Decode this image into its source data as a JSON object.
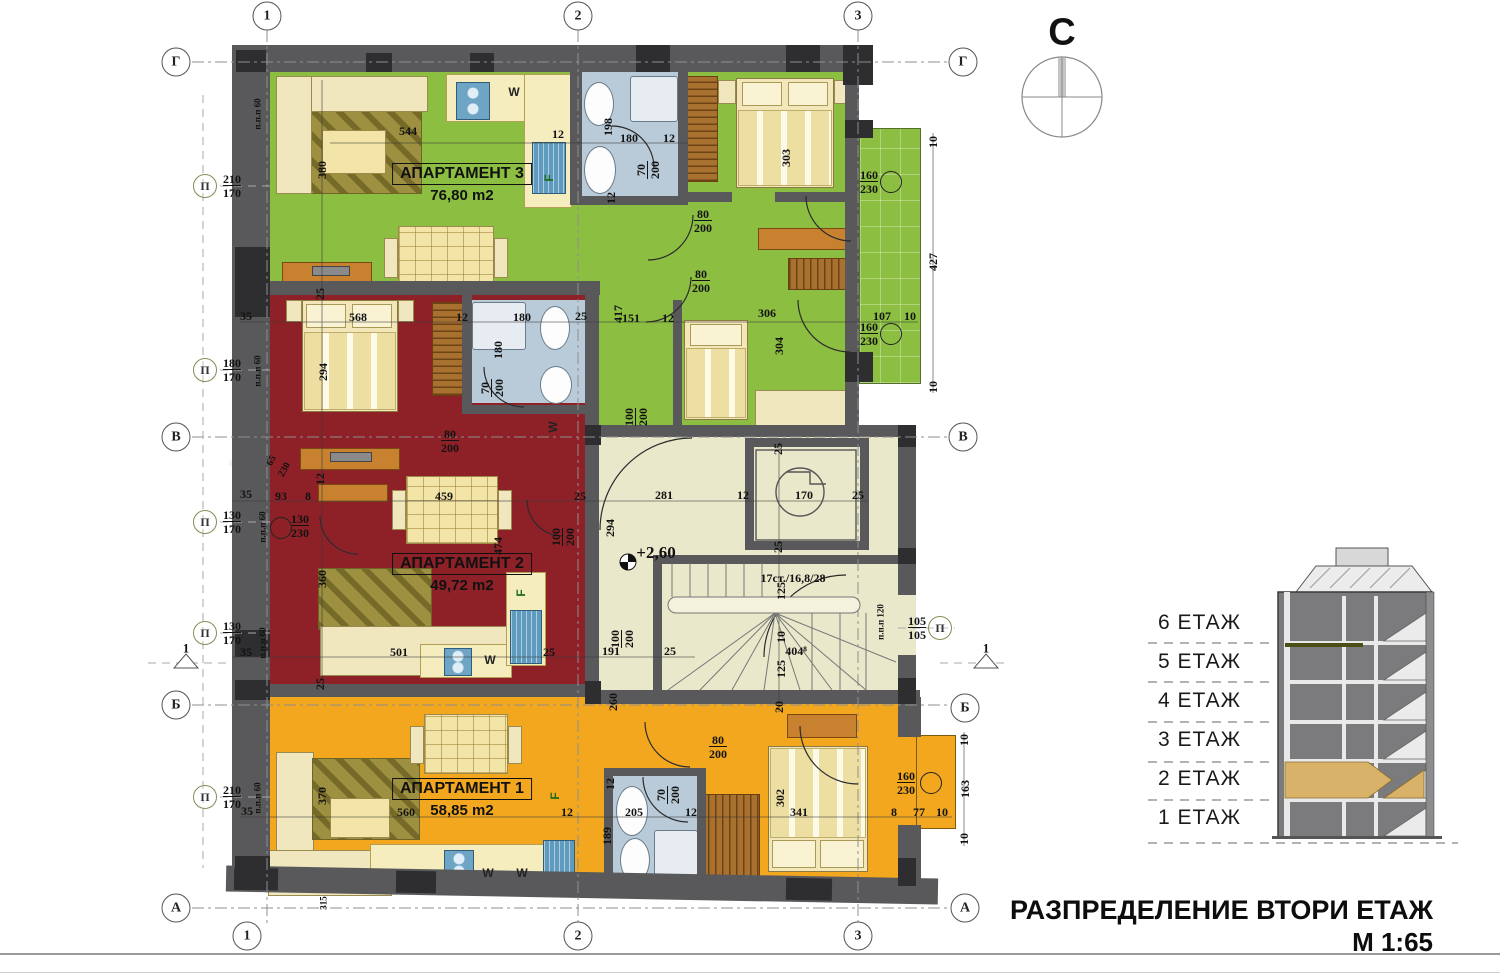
{
  "meta": {
    "drawing_title": "РАЗПРЕДЕЛЕНИЕ ВТОРИ ЕТАЖ",
    "scale": "М 1:65"
  },
  "compass": {
    "label": "С"
  },
  "watermark": {
    "line1": "Bulgarian",
    "line2": "Properties"
  },
  "legend": {
    "floors": [
      "6 ЕТАЖ",
      "5 ЕТАЖ",
      "4 ЕТАЖ",
      "3 ЕТАЖ",
      "2 ЕТАЖ",
      "1 ЕТАЖ"
    ]
  },
  "apartments": [
    {
      "name": "АПАРТАМЕНТ 3",
      "area": "76,80 m2",
      "color": "#8cbe41",
      "lx": 462,
      "ly": 163
    },
    {
      "name": "АПАРТАМЕНТ 2",
      "area": "49,72 m2",
      "color": "#8e2127",
      "lx": 462,
      "ly": 553
    },
    {
      "name": "АПАРТАМЕНТ 1",
      "area": "58,85 m2",
      "color": "#f2a71f",
      "lx": 462,
      "ly": 778
    }
  ],
  "colors": {
    "wall": "#59595b",
    "wall_dark": "#2e2e30",
    "corridor": "#eae8cb",
    "bathroom": "#b9cbd8",
    "balcony": "#8cbe41",
    "niche": "#f2a71f",
    "section_highlight": "#d9b269",
    "section_body": "#7b7b7d"
  },
  "plan": {
    "level_mark": {
      "t": "+2,60",
      "x": 656,
      "y": 553
    },
    "stair_note": {
      "t": "17ст./16,8/28",
      "x": 793,
      "y": 578
    },
    "p_marker_symbol": "П",
    "dims": [
      {
        "t": "544",
        "x": 408,
        "y": 131
      },
      {
        "t": "12",
        "x": 558,
        "y": 134
      },
      {
        "t": "198",
        "x": 608,
        "y": 127,
        "r": -90
      },
      {
        "t": "180",
        "x": 629,
        "y": 138
      },
      {
        "t": "12",
        "x": 669,
        "y": 138
      },
      {
        "t": "12",
        "x": 611,
        "y": 198,
        "r": -90
      },
      {
        "t": "303",
        "x": 786,
        "y": 158,
        "r": -90
      },
      {
        "t": "380",
        "x": 322,
        "y": 170,
        "r": -90
      },
      {
        "t": "10",
        "x": 933,
        "y": 142,
        "r": -90
      },
      {
        "t": "427",
        "x": 933,
        "y": 262,
        "r": -90
      },
      {
        "t": "10",
        "x": 933,
        "y": 387,
        "r": -90
      },
      {
        "t": "107",
        "x": 882,
        "y": 316
      },
      {
        "t": "10",
        "x": 910,
        "y": 316
      },
      {
        "t": "417",
        "x": 618,
        "y": 314,
        "r": -90
      },
      {
        "t": "151",
        "x": 631,
        "y": 318
      },
      {
        "t": "12",
        "x": 668,
        "y": 318
      },
      {
        "t": "306",
        "x": 767,
        "y": 313
      },
      {
        "t": "304",
        "x": 779,
        "y": 346,
        "r": -90
      },
      {
        "t": "25",
        "x": 320,
        "y": 294,
        "r": -90
      },
      {
        "t": "35",
        "x": 246,
        "y": 316
      },
      {
        "t": "568",
        "x": 358,
        "y": 317
      },
      {
        "t": "12",
        "x": 462,
        "y": 317
      },
      {
        "t": "180",
        "x": 522,
        "y": 317
      },
      {
        "t": "25",
        "x": 581,
        "y": 316
      },
      {
        "t": "180",
        "x": 498,
        "y": 350,
        "r": -90
      },
      {
        "t": "294",
        "x": 323,
        "y": 372,
        "r": -90
      },
      {
        "t": "65",
        "x": 272,
        "y": 461,
        "r": -60,
        "s": 10
      },
      {
        "t": "230",
        "x": 285,
        "y": 470,
        "r": -60,
        "s": 10
      },
      {
        "t": "93",
        "x": 281,
        "y": 496
      },
      {
        "t": "8",
        "x": 308,
        "y": 496
      },
      {
        "t": "12",
        "x": 320,
        "y": 479,
        "r": -90
      },
      {
        "t": "459",
        "x": 444,
        "y": 496
      },
      {
        "t": "35",
        "x": 246,
        "y": 494
      },
      {
        "t": "25",
        "x": 580,
        "y": 496
      },
      {
        "t": "474",
        "x": 498,
        "y": 546,
        "r": -90
      },
      {
        "t": "360",
        "x": 322,
        "y": 579,
        "r": -90
      },
      {
        "t": "501",
        "x": 399,
        "y": 652
      },
      {
        "t": "25",
        "x": 549,
        "y": 652
      },
      {
        "t": "35",
        "x": 246,
        "y": 652
      },
      {
        "t": "25",
        "x": 320,
        "y": 684,
        "r": -90
      },
      {
        "t": "281",
        "x": 664,
        "y": 495
      },
      {
        "t": "12",
        "x": 743,
        "y": 495
      },
      {
        "t": "170",
        "x": 804,
        "y": 495
      },
      {
        "t": "25",
        "x": 858,
        "y": 495
      },
      {
        "t": "294",
        "x": 610,
        "y": 528,
        "r": -90
      },
      {
        "t": "25",
        "x": 778,
        "y": 449,
        "r": -90
      },
      {
        "t": "25",
        "x": 778,
        "y": 547,
        "r": -90
      },
      {
        "t": "125",
        "x": 781,
        "y": 591,
        "r": -90
      },
      {
        "t": "10",
        "x": 781,
        "y": 637,
        "r": -90
      },
      {
        "t": "404⁸",
        "x": 796,
        "y": 651
      },
      {
        "t": "125",
        "x": 781,
        "y": 669,
        "r": -90
      },
      {
        "t": "191",
        "x": 611,
        "y": 651
      },
      {
        "t": "25",
        "x": 670,
        "y": 651
      },
      {
        "t": "260",
        "x": 613,
        "y": 702,
        "r": -90
      },
      {
        "t": "20",
        "x": 779,
        "y": 707,
        "r": -90
      },
      {
        "t": "35",
        "x": 247,
        "y": 811
      },
      {
        "t": "560",
        "x": 406,
        "y": 812
      },
      {
        "t": "12",
        "x": 567,
        "y": 812
      },
      {
        "t": "205",
        "x": 634,
        "y": 812
      },
      {
        "t": "12",
        "x": 691,
        "y": 812
      },
      {
        "t": "12",
        "x": 610,
        "y": 784,
        "r": -90
      },
      {
        "t": "189",
        "x": 607,
        "y": 836,
        "r": -90
      },
      {
        "t": "370",
        "x": 322,
        "y": 796,
        "r": -90
      },
      {
        "t": "302",
        "x": 780,
        "y": 798,
        "r": -90
      },
      {
        "t": "341",
        "x": 799,
        "y": 812
      },
      {
        "t": "8",
        "x": 894,
        "y": 812
      },
      {
        "t": "77",
        "x": 919,
        "y": 812
      },
      {
        "t": "10",
        "x": 942,
        "y": 812
      },
      {
        "t": "163",
        "x": 965,
        "y": 789,
        "r": -90
      },
      {
        "t": "10",
        "x": 964,
        "y": 740,
        "r": -90
      },
      {
        "t": "10",
        "x": 964,
        "y": 839,
        "r": -90
      },
      {
        "t": "315",
        "x": 324,
        "y": 903,
        "r": -90,
        "s": 9
      },
      {
        "t": "1",
        "x": 186,
        "y": 648,
        "s": 13
      },
      {
        "t": "1",
        "x": 986,
        "y": 648,
        "s": 13
      },
      {
        "t": "п.п.п 60",
        "x": 258,
        "y": 114,
        "r": -90,
        "s": 9
      },
      {
        "t": "п.п.п 60",
        "x": 258,
        "y": 371,
        "r": -90,
        "s": 9
      },
      {
        "t": "п.п.п 60",
        "x": 263,
        "y": 527,
        "r": -90,
        "s": 9
      },
      {
        "t": "п.п.п 60",
        "x": 263,
        "y": 643,
        "r": -90,
        "s": 9
      },
      {
        "t": "п.п.п 60",
        "x": 258,
        "y": 798,
        "r": -90,
        "s": 9
      },
      {
        "t": "п.п.п 120",
        "x": 881,
        "y": 622,
        "r": -90,
        "s": 9
      }
    ],
    "fractions": [
      {
        "n": "70",
        "d": "200",
        "x": 648,
        "y": 170,
        "r": -90
      },
      {
        "n": "80",
        "d": "200",
        "x": 703,
        "y": 221
      },
      {
        "n": "80",
        "d": "200",
        "x": 701,
        "y": 281
      },
      {
        "n": "160",
        "d": "230",
        "x": 869,
        "y": 182
      },
      {
        "n": "160",
        "d": "230",
        "x": 869,
        "y": 334
      },
      {
        "n": "100",
        "d": "200",
        "x": 636,
        "y": 417,
        "r": -90
      },
      {
        "n": "100",
        "d": "200",
        "x": 563,
        "y": 537,
        "r": -90
      },
      {
        "n": "70",
        "d": "200",
        "x": 492,
        "y": 388,
        "r": -90
      },
      {
        "n": "80",
        "d": "200",
        "x": 450,
        "y": 441
      },
      {
        "n": "130",
        "d": "230",
        "x": 300,
        "y": 526
      },
      {
        "n": "100",
        "d": "200",
        "x": 622,
        "y": 639,
        "r": -90
      },
      {
        "n": "80",
        "d": "200",
        "x": 718,
        "y": 747
      },
      {
        "n": "160",
        "d": "230",
        "x": 906,
        "y": 783
      },
      {
        "n": "70",
        "d": "200",
        "x": 668,
        "y": 795,
        "r": -90
      },
      {
        "n": "105",
        "d": "105",
        "x": 917,
        "y": 628
      },
      {
        "n": "210",
        "d": "170",
        "x": 232,
        "y": 186
      },
      {
        "n": "180",
        "d": "170",
        "x": 232,
        "y": 370
      },
      {
        "n": "130",
        "d": "170",
        "x": 232,
        "y": 522
      },
      {
        "n": "130",
        "d": "170",
        "x": 232,
        "y": 633
      },
      {
        "n": "210",
        "d": "170",
        "x": 232,
        "y": 797
      }
    ],
    "p_markers": [
      {
        "x": 205,
        "y": 186
      },
      {
        "x": 205,
        "y": 370
      },
      {
        "x": 205,
        "y": 522
      },
      {
        "x": 205,
        "y": 633
      },
      {
        "x": 205,
        "y": 797
      },
      {
        "x": 940,
        "y": 628
      }
    ],
    "window_circles": [
      {
        "x": 891,
        "y": 182
      },
      {
        "x": 891,
        "y": 334
      },
      {
        "x": 931,
        "y": 783
      },
      {
        "x": 281,
        "y": 528
      }
    ],
    "grid_marks": [
      {
        "t": "1",
        "x": 267,
        "y": 16
      },
      {
        "t": "2",
        "x": 578,
        "y": 16
      },
      {
        "t": "3",
        "x": 858,
        "y": 16
      },
      {
        "t": "1",
        "x": 247,
        "y": 936
      },
      {
        "t": "2",
        "x": 578,
        "y": 936
      },
      {
        "t": "3",
        "x": 858,
        "y": 936
      },
      {
        "t": "Г",
        "x": 176,
        "y": 62
      },
      {
        "t": "Г",
        "x": 963,
        "y": 62
      },
      {
        "t": "В",
        "x": 176,
        "y": 437
      },
      {
        "t": "В",
        "x": 963,
        "y": 437
      },
      {
        "t": "Б",
        "x": 176,
        "y": 705
      },
      {
        "t": "Б",
        "x": 965,
        "y": 708
      },
      {
        "t": "А",
        "x": 176,
        "y": 908
      },
      {
        "t": "А",
        "x": 965,
        "y": 908
      }
    ],
    "sans_labels": [
      {
        "t": "W",
        "x": 514,
        "y": 92
      },
      {
        "t": "F",
        "x": 549,
        "y": 178,
        "r": -90,
        "c": "#1c6b1c"
      },
      {
        "t": "W",
        "x": 553,
        "y": 427,
        "r": -90
      },
      {
        "t": "F",
        "x": 521,
        "y": 593,
        "r": -90,
        "c": "#1c6b1c"
      },
      {
        "t": "W",
        "x": 490,
        "y": 660
      },
      {
        "t": "F",
        "x": 555,
        "y": 796,
        "r": -90,
        "c": "#1c6b1c"
      },
      {
        "t": "W",
        "x": 488,
        "y": 873
      },
      {
        "t": "W",
        "x": 522,
        "y": 873
      }
    ]
  }
}
